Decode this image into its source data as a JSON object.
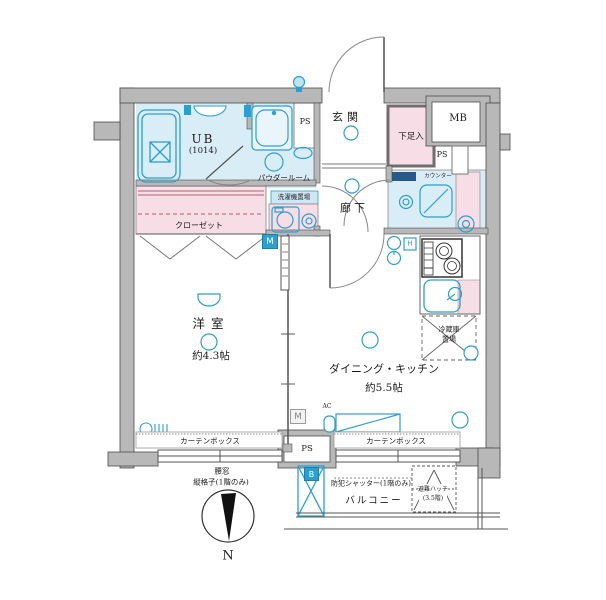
{
  "floor_plan": {
    "colors": {
      "wall": "#b8b8b8",
      "wall_edge": "#4a4a4a",
      "wet_area": "#d9edf7",
      "pink_area": "#f7dde6",
      "accent_cyan": "#2d9fce",
      "counter_navy": "#265a8a",
      "closet_line": "#b2606e"
    },
    "rooms": {
      "unit_bath": {
        "name": "UB",
        "size": "(1014)"
      },
      "powder_room": {
        "name": "パウダールーム"
      },
      "laundry": {
        "name": "洗濯機置場"
      },
      "closet": {
        "name": "クローゼット"
      },
      "entrance": {
        "name": "玄関"
      },
      "shoe_cabinet": {
        "name": "下足入"
      },
      "corridor": {
        "name": "廊下"
      },
      "western_room": {
        "name": "洋室",
        "size": "約4.3帖"
      },
      "dining_kitchen": {
        "name": "ダイニング・キッチン",
        "size": "約5.5帖"
      },
      "fridge_space": {
        "name_line1": "冷蔵庫",
        "name_line2": "置場"
      },
      "balcony": {
        "name": "バルコニー"
      }
    },
    "labels": {
      "meter_box": "MB",
      "pipe_space": "PS",
      "counter": "カウンター",
      "curtain_box": "カーテンボックス",
      "meter": "M",
      "ac": "AC",
      "b_mark": "B",
      "h_mark": "H",
      "security_shutter": "防犯シャッター(1階のみ)",
      "escape_hatch_line1": "避難ハッチ",
      "escape_hatch_line2": "(3.5階)",
      "window_note_line1": "腰窓",
      "window_note_line2": "縦格子(1階のみ)",
      "north": "N"
    }
  }
}
